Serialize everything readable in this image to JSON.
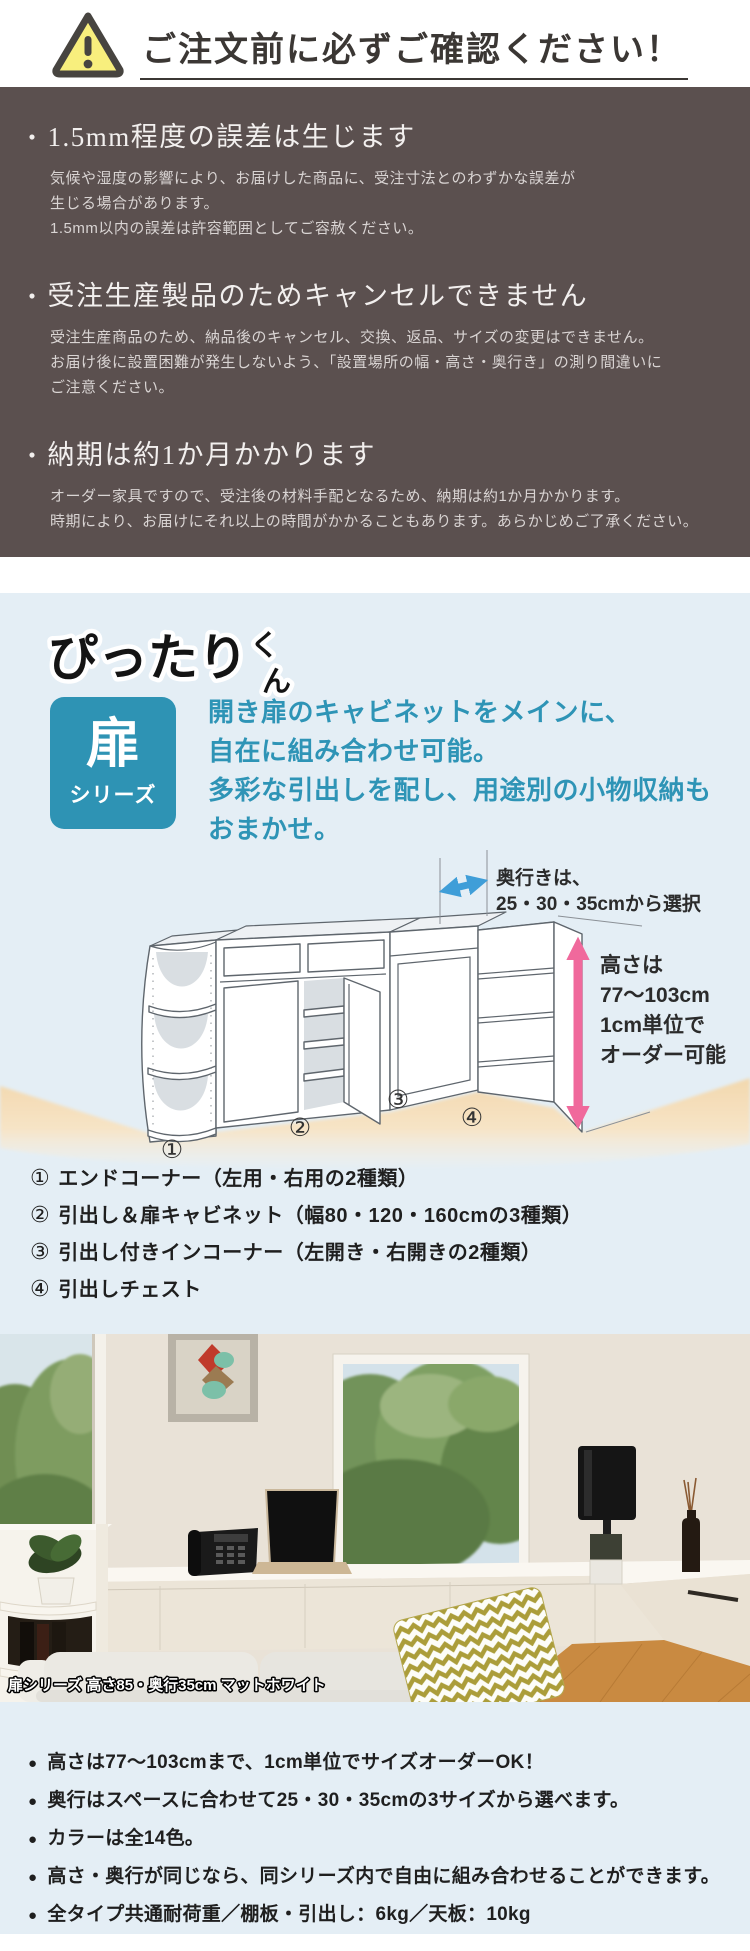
{
  "colors": {
    "brown-bg": "#5b504f",
    "light-blue-bg": "#e4eef5",
    "teal": "#2e93b4",
    "teal-text": "#2e94b6",
    "warning-yellow": "#f8ef7d",
    "warning-border": "#474440",
    "title-dark": "#3b3734",
    "notice-heading": "#f2efee",
    "notice-body": "#d9d4d3",
    "arrow-blue": "#3f9ed8",
    "arrow-pink": "#f0699c",
    "floor-tan": "#f5dcb6",
    "ink": "#2b2b2b"
  },
  "header": {
    "title": "ご注文前に必ずご確認ください！"
  },
  "notices": {
    "bullet": "・",
    "items": [
      {
        "heading": "1.5mm程度の誤差は生じます",
        "lines": [
          "気候や湿度の影響により、お届けした商品に、受注寸法とのわずかな誤差が",
          "生じる場合があります。",
          "1.5mm以内の誤差は許容範囲としてご容赦ください。"
        ]
      },
      {
        "heading": "受注生産製品のためキャンセルできません",
        "lines": [
          "受注生産商品のため、納品後のキャンセル、交換、返品、サイズの変更はできません。",
          "お届け後に設置困難が発生しないよう、「設置場所の幅・高さ・奥行き」の測り間違いに",
          "ご注意ください。"
        ]
      },
      {
        "heading": "納期は約1か月かかります",
        "lines": [
          "オーダー家具ですので、受注後の材料手配となるため、納期は約1か月かかります。",
          "時期により、お届けにそれ以上の時間がかかることもあります。あらかじめご了承ください。"
        ]
      }
    ]
  },
  "series": {
    "logo_main": "ぴったり",
    "logo_small_top": "く",
    "logo_small_bottom": "ん",
    "badge_kanji": "扉",
    "badge_label": "シリーズ",
    "description": [
      "開き扉のキャビネットをメインに、",
      "自在に組み合わせ可能。",
      "多彩な引出しを配し、用途別の小物収納も",
      "おまかせ。"
    ]
  },
  "diagram": {
    "depth_label_line1": "奥行きは、",
    "depth_label_line2": "25・30・35cmから選択",
    "height_label_line1": "高さは",
    "height_label_line2": "77〜103cm",
    "height_label_line3": "1cm単位で",
    "height_label_line4": "オーダー可能",
    "unit_numbers": [
      "①",
      "②",
      "③",
      "④"
    ]
  },
  "legend": {
    "items": [
      {
        "num": "①",
        "text": "エンドコーナー（左用・右用の2種類）"
      },
      {
        "num": "②",
        "text": "引出し＆扉キャビネット（幅80・120・160cmの3種類）"
      },
      {
        "num": "③",
        "text": "引出し付きインコーナー（左開き・右開きの2種類）"
      },
      {
        "num": "④",
        "text": "引出しチェスト"
      }
    ]
  },
  "photo": {
    "caption": "扉シリーズ 高さ85・奥行35cm マットホワイト"
  },
  "features": {
    "bullet": "●",
    "items": [
      "高さは77〜103cmまで、1cm単位でサイズオーダーOK！",
      "奥行はスペースに合わせて25・30・35cmの3サイズから選べます。",
      "カラーは全14色。",
      "高さ・奥行が同じなら、同シリーズ内で自由に組み合わせることができます。",
      "全タイプ共通耐荷重／棚板・引出し：6kg／天板：10kg"
    ]
  }
}
